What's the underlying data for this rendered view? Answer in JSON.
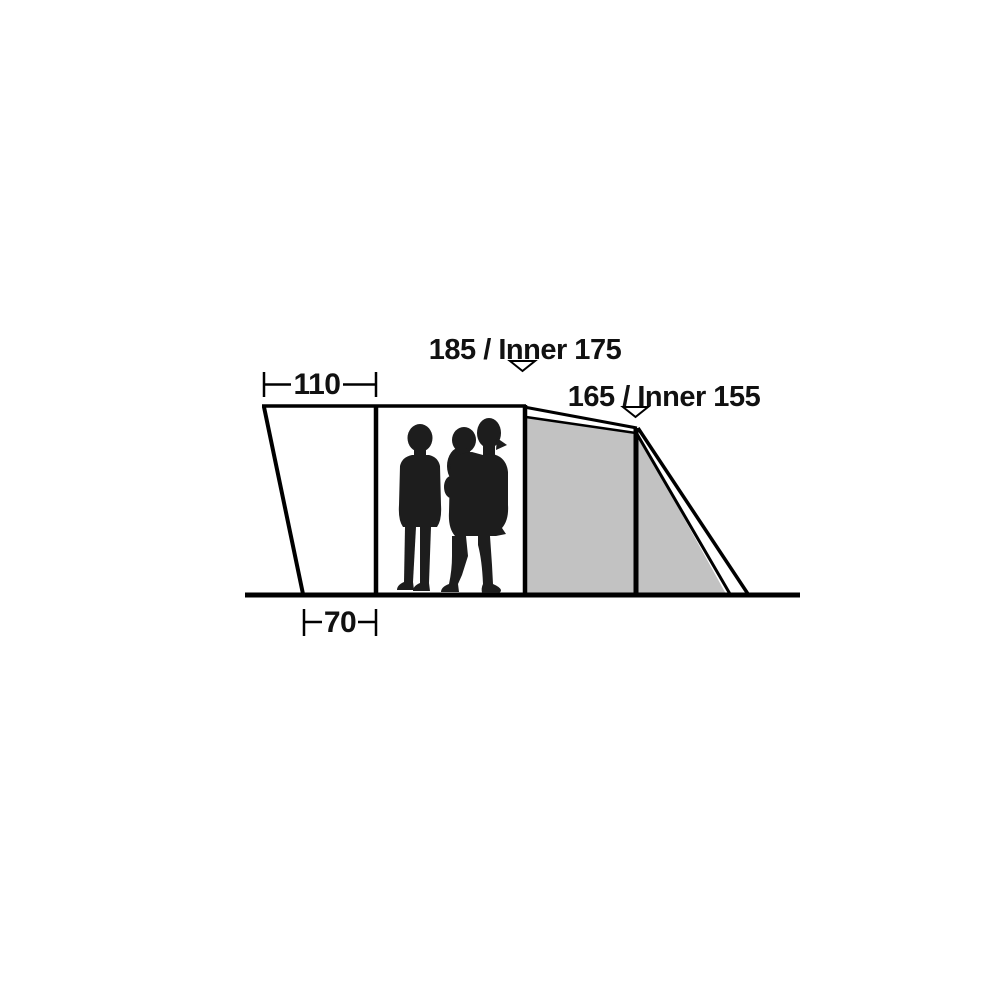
{
  "diagram": {
    "labels": {
      "height_main": "185 / Inner 175",
      "height_rear": "165 / Inner 155",
      "width_top": "110",
      "width_bottom": "70"
    },
    "colors": {
      "line": "#000000",
      "text": "#111111",
      "panel_gray": "#c2c2c2",
      "silhouette": "#1d1d1d",
      "marker_fill": "#ffffff",
      "background": "#ffffff"
    }
  }
}
